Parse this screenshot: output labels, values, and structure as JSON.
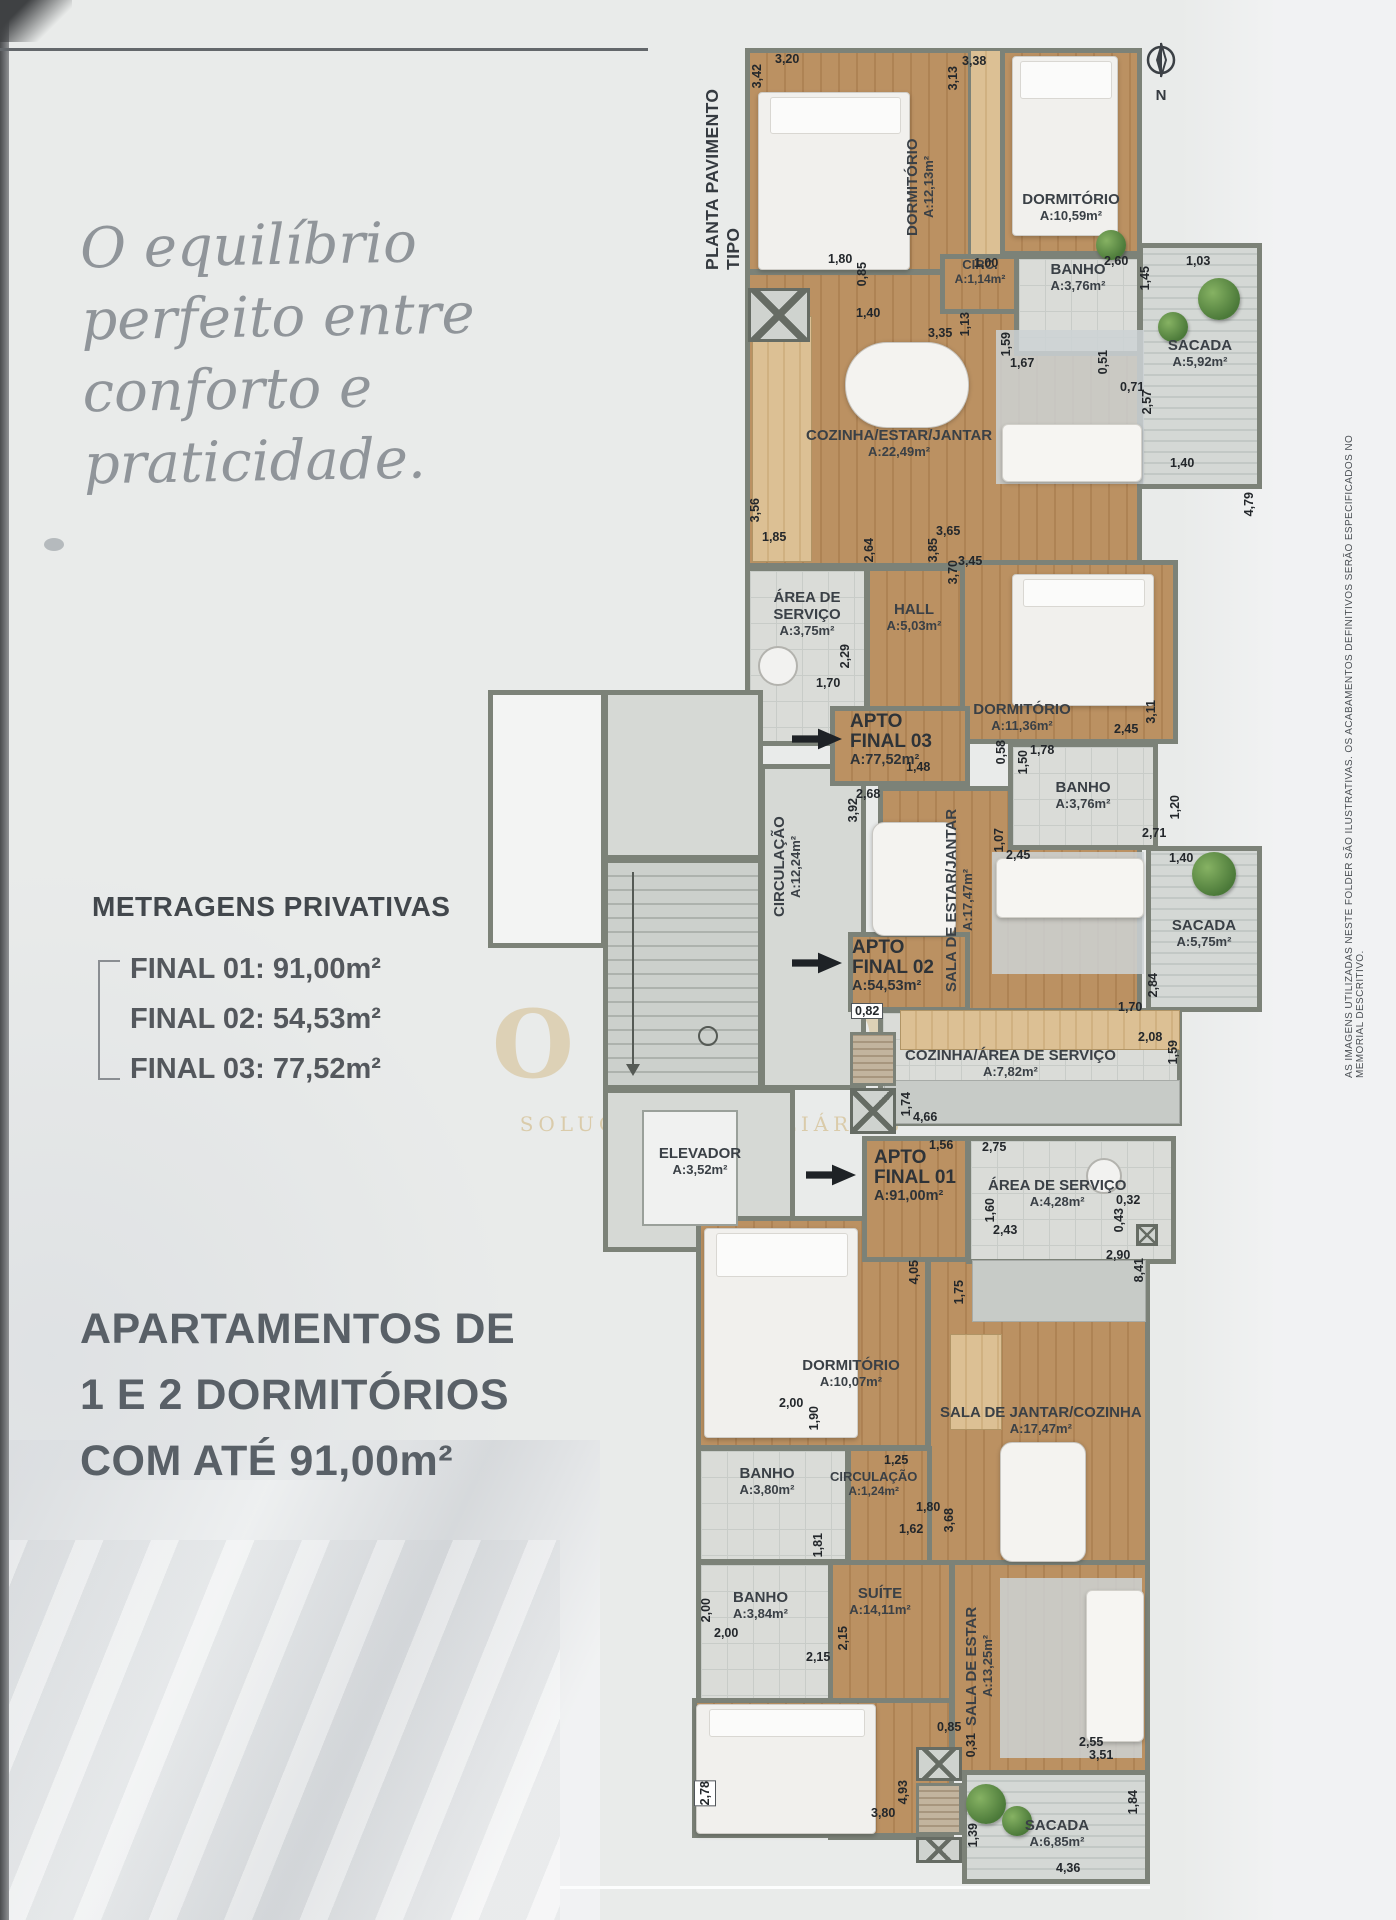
{
  "page": {
    "script_headline": [
      "O equilíbrio",
      "perfeito entre",
      "conforto e",
      "praticidade."
    ],
    "metragens": {
      "title": "METRAGENS PRIVATIVAS",
      "items": [
        "FINAL 01: 91,00m²",
        "FINAL 02:  54,53m²",
        "FINAL 03: 77,52m²"
      ]
    },
    "bottom_headline": [
      "APARTAMENTOS DE",
      "1 E 2 DORMITÓRIOS",
      "COM ATÉ 91,00m²"
    ],
    "plan_title": "PLANTA PAVIMENTO TIPO",
    "compass_label": "N",
    "disclaimer": "AS IMAGENS UTILIZADAS NESTE FOLDER SÃO ILUSTRATIVAS. OS ACABAMENTOS DEFINITIVOS SERÃO ESPECIFICADOS NO MEMORIAL DESCRITIVO.",
    "watermark": {
      "line1": "OURO",
      "line2": "SOLUÇÕES IMOBILIÁRIAS"
    }
  },
  "plan": {
    "apartments": [
      {
        "name": "APTO FINAL 03",
        "area": "A:77,52m²"
      },
      {
        "name": "APTO FINAL 02",
        "area": "A:54,53m²"
      },
      {
        "name": "APTO FINAL 01",
        "area": "A:91,00m²"
      }
    ],
    "rooms": [
      {
        "name": "DORMITÓRIO",
        "area": "A:12,13m²"
      },
      {
        "name": "DORMITÓRIO",
        "area": "A:10,59m²"
      },
      {
        "name": "CIRC.",
        "area": "A:1,14m²"
      },
      {
        "name": "BANHO",
        "area": "A:3,76m²"
      },
      {
        "name": "SACADA",
        "area": "A:5,92m²"
      },
      {
        "name": "COZINHA/ESTAR/JANTAR",
        "area": "A:22,49m²"
      },
      {
        "name": "ÁREA DE SERVIÇO",
        "area": "A:3,75m²"
      },
      {
        "name": "HALL",
        "area": "A:5,03m²"
      },
      {
        "name": "DORMITÓRIO",
        "area": "A:11,36m²"
      },
      {
        "name": "BANHO",
        "area": "A:3,76m²"
      },
      {
        "name": "SALA DE ESTAR/JANTAR",
        "area": "A:17,47m²"
      },
      {
        "name": "SACADA",
        "area": "A:5,75m²"
      },
      {
        "name": "COZINHA/ÁREA DE SERVIÇO",
        "area": "A:7,82m²"
      },
      {
        "name": "CIRCULAÇÃO",
        "area": "A:12,24m²"
      },
      {
        "name": "ELEVADOR",
        "area": "A:3,52m²"
      },
      {
        "name": "DORMITÓRIO",
        "area": "A:10,07m²"
      },
      {
        "name": "ÁREA DE SERVIÇO",
        "area": "A:4,28m²"
      },
      {
        "name": "SALA DE JANTAR/COZINHA",
        "area": "A:17,47m²"
      },
      {
        "name": "BANHO",
        "area": "A:3,80m²"
      },
      {
        "name": "CIRCULAÇÃO",
        "area": "A:1,24m²"
      },
      {
        "name": "BANHO",
        "area": "A:3,84m²"
      },
      {
        "name": "SUÍTE",
        "area": "A:14,11m²"
      },
      {
        "name": "SALA DE ESTAR",
        "area": "A:13,25m²"
      },
      {
        "name": "SACADA",
        "area": "A:6,85m²"
      }
    ],
    "dims": [
      "3,20",
      "3,42",
      "3,38",
      "3,13",
      "1,80",
      "0,85",
      "1,40",
      "1,00",
      "2,60",
      "1,45",
      "1,03",
      "3,35",
      "1,13",
      "1,59",
      "1,67",
      "0,51",
      "0,71",
      "2,57",
      "4,79",
      "1,40",
      "3,56",
      "1,85",
      "2,64",
      "3,85",
      "3,65",
      "3,45",
      "3,70",
      "2,29",
      "1,70",
      "1,48",
      "0,58",
      "1,50",
      "1,78",
      "2,45",
      "3,11",
      "1,20",
      "2,71",
      "1,07",
      "2,45",
      "1,40",
      "2,68",
      "3,92",
      "0,82",
      "2,84",
      "1,70",
      "2,08",
      "1,59",
      "1,74",
      "4,66",
      "1,56",
      "2,75",
      "4,05",
      "1,75",
      "1,60",
      "2,43",
      "0,32",
      "0,43",
      "2,90",
      "8,41",
      "2,00",
      "1,90",
      "1,25",
      "1,80",
      "1,62",
      "3,68",
      "1,81",
      "2,00",
      "2,00",
      "2,15",
      "2,15",
      "2,78",
      "3,80",
      "4,93",
      "0,85",
      "0,31",
      "3,51",
      "1,39",
      "1,84",
      "4,36",
      "2,55"
    ]
  }
}
